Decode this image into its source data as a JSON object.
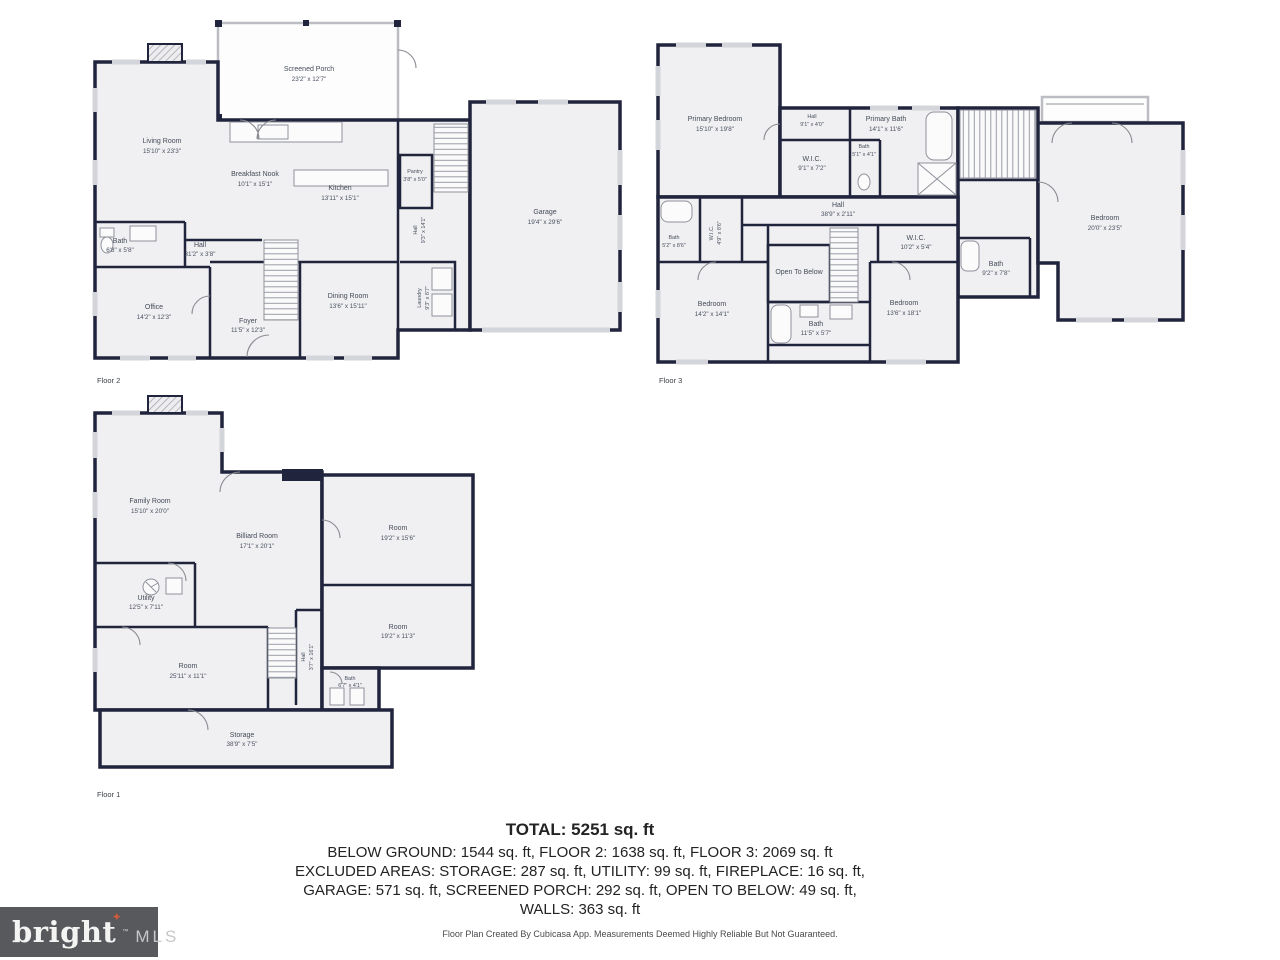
{
  "colors": {
    "wall": "#20243c",
    "room_fill": "#f0f0f2",
    "porch_stroke": "#bcbdc3",
    "fixture": "#8f929b",
    "label": "#454b58",
    "logo_background": "#58595d",
    "logo_star": "#cf5b3d"
  },
  "floors": {
    "floor2": {
      "label": "Floor 2",
      "rooms": {
        "screened_porch": {
          "name": "Screened Porch",
          "dims": "23'2\" x 12'7\""
        },
        "living_room": {
          "name": "Living Room",
          "dims": "15'10\" x 23'3\""
        },
        "breakfast_nook": {
          "name": "Breakfast Nook",
          "dims": "10'1\" x 15'1\""
        },
        "kitchen": {
          "name": "Kitchen",
          "dims": "13'11\" x 15'1\""
        },
        "pantry": {
          "name": "Pantry",
          "dims": "3'8\" x 5'0\""
        },
        "garage": {
          "name": "Garage",
          "dims": "19'4\" x 29'6\""
        },
        "hall_side": {
          "name": "Hall",
          "dims": "9'3\" x 14'1\""
        },
        "bath": {
          "name": "Bath",
          "dims": "6'8\" x 5'8\""
        },
        "hall": {
          "name": "Hall",
          "dims": "31'2\" x 3'8\""
        },
        "office": {
          "name": "Office",
          "dims": "14'2\" x 12'3\""
        },
        "foyer": {
          "name": "Foyer",
          "dims": "11'5\" x 12'3\""
        },
        "dining_room": {
          "name": "Dining Room",
          "dims": "13'6\" x 15'11\""
        },
        "laundry": {
          "name": "Laundry",
          "dims": "9'3\" x 8'7\""
        }
      }
    },
    "floor3": {
      "label": "Floor 3",
      "rooms": {
        "primary_bedroom": {
          "name": "Primary Bedroom",
          "dims": "15'10\" x 19'8\""
        },
        "hall_upper": {
          "name": "Hall",
          "dims": "9'1\" x 4'0\""
        },
        "primary_bath": {
          "name": "Primary Bath",
          "dims": "14'1\" x 11'6\""
        },
        "wic_primary": {
          "name": "W.I.C.",
          "dims": "9'1\" x 7'2\""
        },
        "bath_small": {
          "name": "Bath",
          "dims": "5'1\" x 4'1\""
        },
        "hall_main": {
          "name": "Hall",
          "dims": "38'9\" x 2'11\""
        },
        "bath_left": {
          "name": "Bath",
          "dims": "5'2\" x 8'6\""
        },
        "wic_left": {
          "name": "W.I.C.",
          "dims": "4'9\" x 8'6\""
        },
        "bedroom_left": {
          "name": "Bedroom",
          "dims": "14'2\" x 14'1\""
        },
        "open_to_below": {
          "name": "Open To Below"
        },
        "bath_middle": {
          "name": "Bath",
          "dims": "11'5\" x 5'7\""
        },
        "wic_right": {
          "name": "W.I.C.",
          "dims": "10'2\" x 5'4\""
        },
        "bedroom_middle": {
          "name": "Bedroom",
          "dims": "13'6\" x 18'1\""
        },
        "bath_right": {
          "name": "Bath",
          "dims": "9'2\" x 7'8\""
        },
        "bedroom_right": {
          "name": "Bedroom",
          "dims": "20'0\" x 23'5\""
        }
      }
    },
    "floor1": {
      "label": "Floor 1",
      "rooms": {
        "family_room": {
          "name": "Family Room",
          "dims": "15'10\" x 20'0\""
        },
        "billiard_room": {
          "name": "Billiard Room",
          "dims": "17'1\" x 20'1\""
        },
        "room_upper_right": {
          "name": "Room",
          "dims": "19'2\" x 15'6\""
        },
        "utility": {
          "name": "Utility",
          "dims": "12'5\" x 7'11\""
        },
        "room_left": {
          "name": "Room",
          "dims": "25'11\" x 11'1\""
        },
        "hall": {
          "name": "Hall",
          "dims": "3'7\" x 16'1\""
        },
        "room_lower_right": {
          "name": "Room",
          "dims": "19'2\" x 11'3\""
        },
        "bath": {
          "name": "Bath",
          "dims": "6'7\" x 4'1\""
        },
        "storage": {
          "name": "Storage",
          "dims": "38'9\" x 7'5\""
        }
      }
    }
  },
  "summary": {
    "total": "TOTAL: 5251 sq. ft",
    "line1": "BELOW GROUND: 1544 sq. ft, FLOOR 2: 1638 sq. ft, FLOOR 3: 2069 sq. ft",
    "line2": "EXCLUDED AREAS: STORAGE: 287 sq. ft, UTILITY: 99 sq. ft, FIREPLACE: 16 sq. ft,",
    "line3": "GARAGE: 571 sq. ft, SCREENED PORCH: 292 sq. ft, OPEN TO BELOW: 49 sq. ft,",
    "line4": "WALLS: 363 sq. ft"
  },
  "footer": {
    "disclaimer": "Floor Plan Created By Cubicasa App. Measurements Deemed Highly Reliable But Not Guaranteed."
  },
  "logo": {
    "brand": "bright",
    "star": "✦",
    "tm": "™",
    "suffix": "MLS"
  }
}
